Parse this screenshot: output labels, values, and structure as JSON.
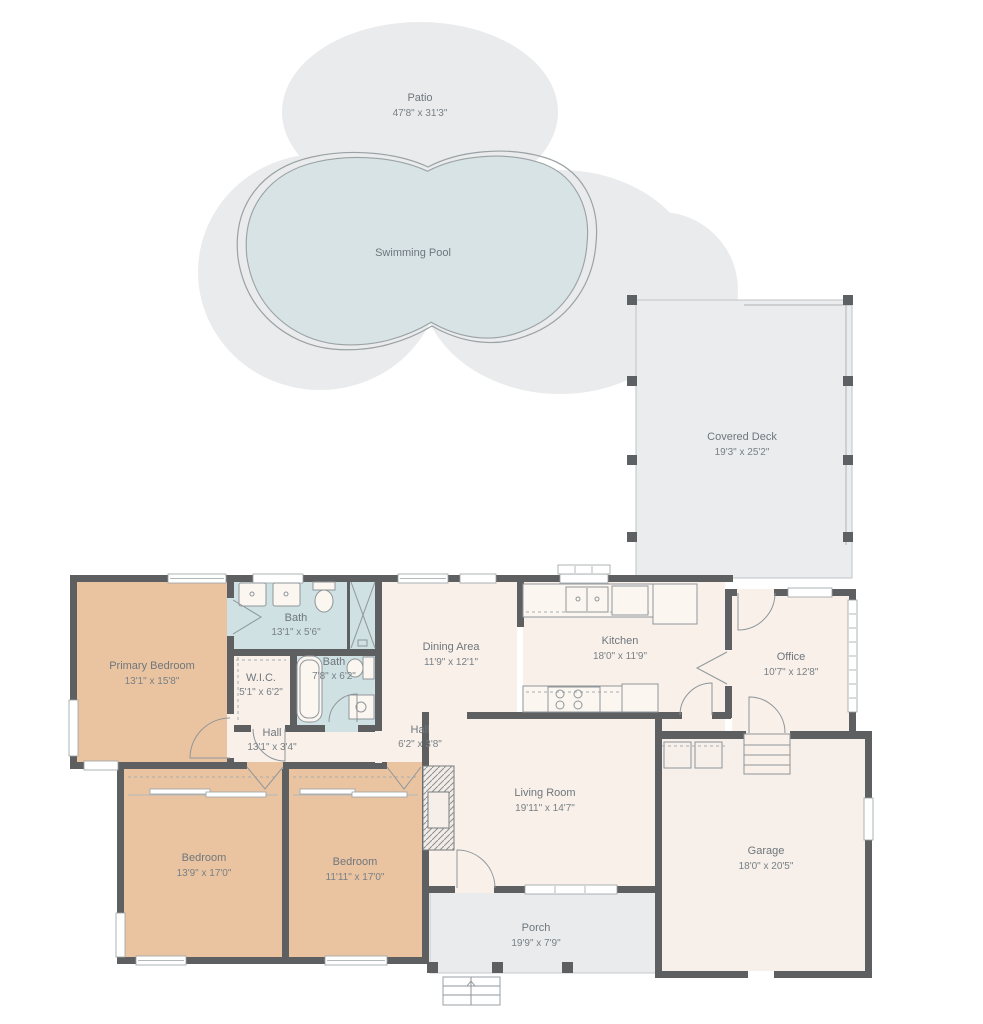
{
  "plan": {
    "type": "floor-plan",
    "palette": {
      "wall": "#5d5f60",
      "room": "#f8f0e9",
      "bedroom": "#eac4a1",
      "bath": "#cfe1e2",
      "outdoor": "#e9ebec",
      "pool_water": "#d7e3e5",
      "pool_edge": "#9ba2a5",
      "label_text": "#6f767d"
    },
    "rooms": {
      "patio": {
        "name": "Patio",
        "dims": "47'8\" x 31'3\""
      },
      "swimming_pool": {
        "name": "Swimming Pool",
        "dims": ""
      },
      "covered_deck": {
        "name": "Covered Deck",
        "dims": "19'3\" x 25'2\""
      },
      "primary_bedroom": {
        "name": "Primary Bedroom",
        "dims": "13'1\" x 15'8\""
      },
      "bath_main": {
        "name": "Bath",
        "dims": "13'1\" x 5'6\""
      },
      "wic": {
        "name": "W.I.C.",
        "dims": "5'1\" x 6'2\""
      },
      "bath_second": {
        "name": "Bath",
        "dims": "7'8\" x 6'2\""
      },
      "hall_bedroom": {
        "name": "Hall",
        "dims": "13'1\" x 3'4\""
      },
      "hall_main": {
        "name": "Hall",
        "dims": "6'2\" x 3'8\""
      },
      "dining_area": {
        "name": "Dining Area",
        "dims": "11'9\" x 12'1\""
      },
      "kitchen": {
        "name": "Kitchen",
        "dims": "18'0\" x 11'9\""
      },
      "office": {
        "name": "Office",
        "dims": "10'7\" x 12'8\""
      },
      "living_room": {
        "name": "Living Room",
        "dims": "19'11\" x 14'7\""
      },
      "garage": {
        "name": "Garage",
        "dims": "18'0\" x 20'5\""
      },
      "bedroom_left": {
        "name": "Bedroom",
        "dims": "13'9\" x 17'0\""
      },
      "bedroom_right": {
        "name": "Bedroom",
        "dims": "11'11\" x 17'0\""
      },
      "porch": {
        "name": "Porch",
        "dims": "19'9\" x 7'9\""
      }
    }
  }
}
